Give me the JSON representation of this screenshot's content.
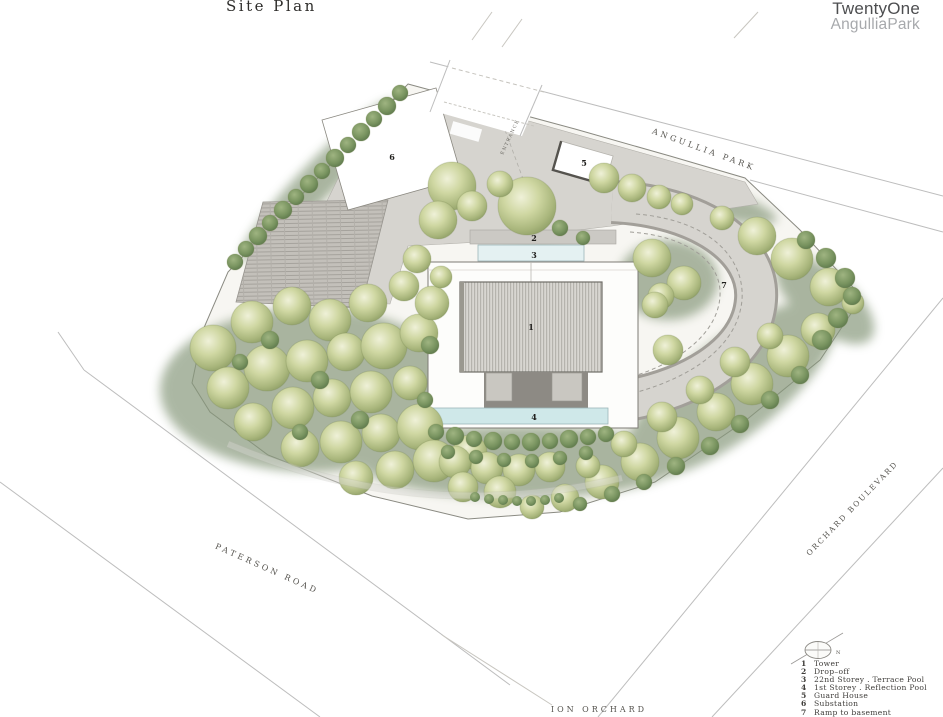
{
  "header": {
    "title": "Site Plan",
    "brand_line1": "TwentyOne",
    "brand_line2": "AngulliaPark"
  },
  "roads": {
    "angullia_park": "ANGULLIA PARK",
    "paterson_road": "PATERSON ROAD",
    "orchard_boulevard": "ORCHARD BOULEVARD",
    "ion_orchard": "ION ORCHARD"
  },
  "plan": {
    "entrance": "ENTRANCE",
    "north": "N"
  },
  "legend": {
    "items": [
      {
        "num": "1",
        "label": "Tower"
      },
      {
        "num": "2",
        "label": "Drop–off"
      },
      {
        "num": "3",
        "label": "22nd Storey . Terrace Pool"
      },
      {
        "num": "4",
        "label": "1st Storey . Reflection Pool"
      },
      {
        "num": "5",
        "label": "Guard House"
      },
      {
        "num": "6",
        "label": "Substation"
      },
      {
        "num": "7",
        "label": "Ramp to basement"
      }
    ]
  },
  "colors": {
    "tree_green": "#a9b67c",
    "ground_green": "#87997b",
    "pool_cyan": "#cfe8e9",
    "drive_gray": "#d6d4cf",
    "road_line": "#bdbdbd"
  }
}
